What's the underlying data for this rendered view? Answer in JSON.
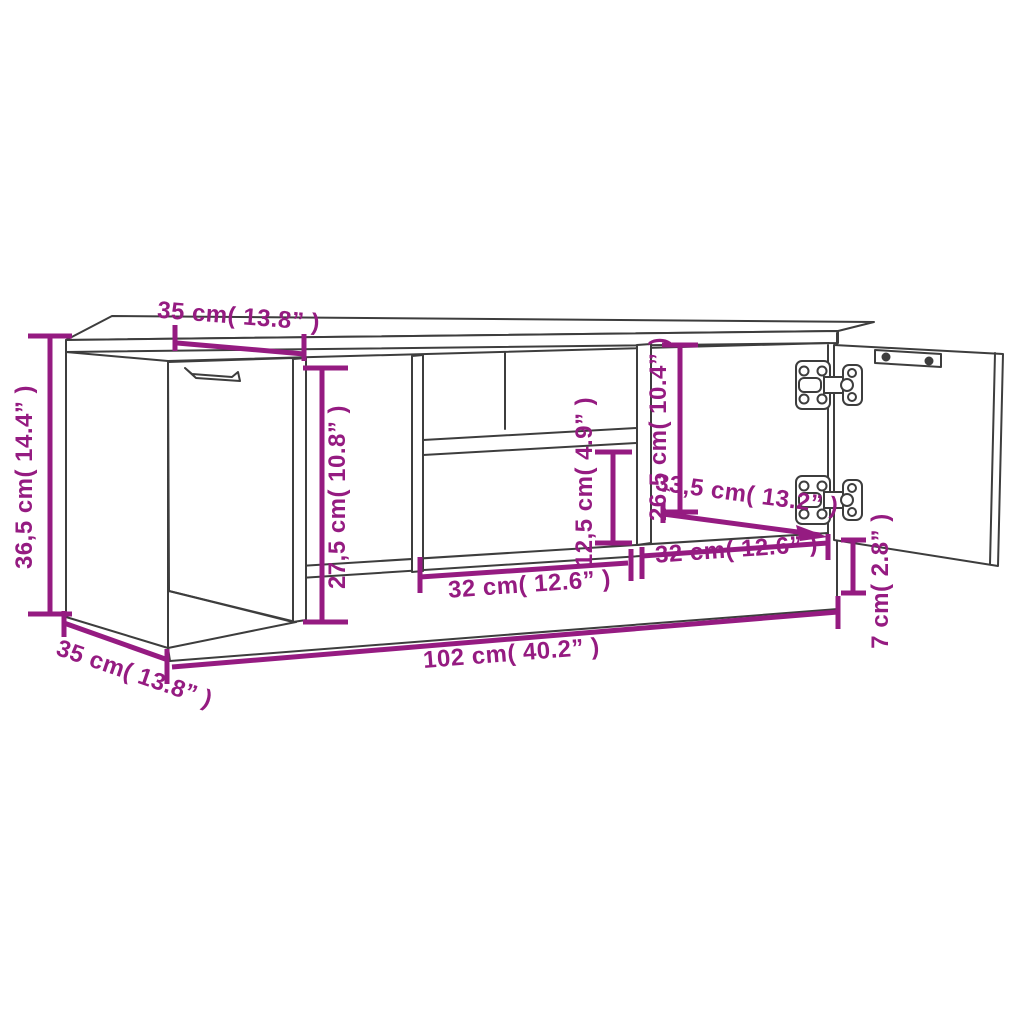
{
  "page": {
    "background": "#ffffff"
  },
  "diagram": {
    "type": "furniture-dimension-drawing",
    "subject": "TV cabinet with left closed door, open shelf compartments and right open door",
    "colors": {
      "dimension": "#951B81",
      "outline": "#3D3D3D",
      "background": "#ffffff"
    },
    "labels": {
      "top_depth": "35 cm( 13.8” )",
      "height": "36,5 cm( 14.4” )",
      "interior_height": "27,5 cm( 10.8” )",
      "shelf_gap": "12,5 cm( 4.9” )",
      "right_interior_height": "26,5 cm( 10.4” )",
      "interior_depth": "33,5 cm( 13.2” )",
      "mid_width": "32 cm( 12.6” )",
      "right_width": "32 cm( 12.6” )",
      "plinth_height": "7 cm( 2.8” )",
      "total_width": "102 cm( 40.2” )",
      "bottom_depth": "35 cm( 13.8” )"
    }
  }
}
